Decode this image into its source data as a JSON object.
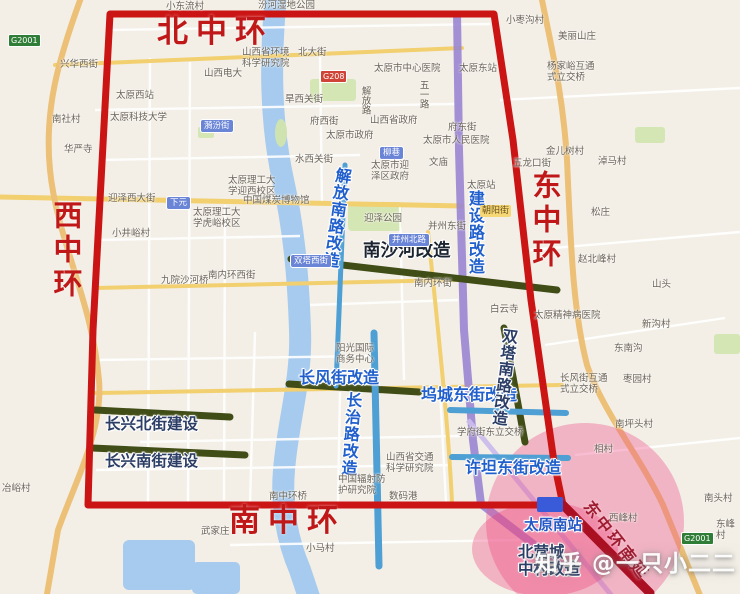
{
  "meta": {
    "watermark": "知乎 @一只小二二"
  },
  "colors": {
    "ring_text_red": "#c01818",
    "boundary_red": "#cb1414",
    "extension_red": "#ab0f22",
    "project_green_bar": "#414d16",
    "project_blue_bar": "#4d9fd4",
    "railway_purple": "#9a85d2",
    "project_text_blue": "#2160cc",
    "project_text_navy": "#2c3e66",
    "development_zone_pink": "#f0548c",
    "road_yellow": "#f2cf6f",
    "water_blue": "#a6cbee"
  },
  "rings": {
    "north": "北中环",
    "south": "南中环",
    "west": "西中环",
    "east": "东中环"
  },
  "projects": [
    "解放南路改造",
    "建设路改造",
    "南沙河改造",
    "长风街改造",
    "长治路改造",
    "坞城东街改造",
    "双塔南路改造",
    "许坦东街改造",
    "长兴北街建设",
    "长兴南街建设",
    "东中环南延",
    "北营城中村改造"
  ],
  "labels": [
    {
      "name": "ring-label-north",
      "text": "北中环",
      "x": 157,
      "y": 17,
      "cls": "ring"
    },
    {
      "name": "ring-label-south",
      "text": "南中环",
      "x": 229,
      "y": 506,
      "cls": "ring"
    },
    {
      "name": "ring-label-west",
      "text": "西中环",
      "x": 51,
      "y": 200,
      "cls": "ringv"
    },
    {
      "name": "ring-label-east",
      "text": "东中环",
      "x": 530,
      "y": 170,
      "cls": "ringv"
    },
    {
      "name": "project-label-jiefang-south-rd",
      "text": "解放南路改造",
      "x": 334,
      "y": 166,
      "cls": "projv halo",
      "rot": 8
    },
    {
      "name": "project-label-jianshe-rd",
      "text": "建设路改造",
      "x": 466,
      "y": 190,
      "cls": "projv halo"
    },
    {
      "name": "project-label-nanshahe",
      "text": "南沙河改造",
      "x": 363,
      "y": 242,
      "cls": "projdark halo"
    },
    {
      "name": "project-label-changfeng-st",
      "text": "长风街改造",
      "x": 299,
      "y": 369,
      "cls": "proj halo"
    },
    {
      "name": "project-label-changzhi-rd",
      "text": "长治路改造",
      "x": 344,
      "y": 391,
      "cls": "projv halo",
      "rot": 4
    },
    {
      "name": "project-label-wucheng-east-st",
      "text": "坞城东街改造",
      "x": 421,
      "y": 386,
      "cls": "proj halo"
    },
    {
      "name": "project-label-shuangta-south-rd",
      "text": "双塔南路改造",
      "x": 501,
      "y": 327,
      "cls": "projvnavy halo",
      "rot": 7
    },
    {
      "name": "project-label-xutan-east-st",
      "text": "许坦东街改造",
      "x": 465,
      "y": 459,
      "cls": "proj halo"
    },
    {
      "name": "project-label-changxing-north-st",
      "text": "长兴北街建设",
      "x": 105,
      "y": 416,
      "cls": "projnavy halo"
    },
    {
      "name": "project-label-changxing-south-st",
      "text": "长兴南街建设",
      "x": 105,
      "y": 453,
      "cls": "projnavy halo"
    },
    {
      "name": "project-label-east-ring-south-extension",
      "text": "东中环南延",
      "x": 594,
      "y": 498,
      "cls": "ext",
      "rot": 52
    },
    {
      "name": "station-label-taiyuan-south",
      "text": "太原南站",
      "x": 524,
      "y": 518,
      "cls": "station halo"
    },
    {
      "name": "project-label-beiying-village",
      "text": "北营城\n中村改造",
      "x": 518,
      "y": 544,
      "cls": "projnavy halo"
    },
    {
      "name": "road-badge-g2001-west",
      "text": "G2001",
      "x": 8,
      "y": 34,
      "cls": "badge-g"
    },
    {
      "name": "road-badge-g2001-southeast",
      "text": "G2001",
      "x": 681,
      "y": 532,
      "cls": "badge-g"
    },
    {
      "name": "road-badge-g208",
      "text": "G208",
      "x": 320,
      "y": 70,
      "cls": "badge-r"
    },
    {
      "name": "road-badge-xiayuan",
      "text": "下元",
      "x": 166,
      "y": 196,
      "cls": "badge-b"
    },
    {
      "name": "road-badge-yifen-st",
      "text": "漪汾街",
      "x": 200,
      "y": 119,
      "cls": "badge-b"
    },
    {
      "name": "road-badge-liuxiang",
      "text": "柳巷",
      "x": 379,
      "y": 146,
      "cls": "badge-b"
    },
    {
      "name": "road-badge-bingzhou-north-rd",
      "text": "并州北路",
      "x": 388,
      "y": 233,
      "cls": "badge-b"
    },
    {
      "name": "road-badge-shuangta-west-st",
      "text": "双塔西街",
      "x": 290,
      "y": 254,
      "cls": "badge-b"
    },
    {
      "name": "road-badge-chaoyang-st",
      "text": "朝阳街",
      "x": 480,
      "y": 205,
      "cls": "badge-y"
    },
    {
      "name": "map-label-village",
      "text": "小东流村",
      "x": 166,
      "y": 2,
      "cls": "base"
    },
    {
      "name": "map-label-park",
      "text": "汾河湿地公园",
      "x": 258,
      "y": 1,
      "cls": "base"
    },
    {
      "name": "map-label-street",
      "text": "兴华西街",
      "x": 60,
      "y": 60,
      "cls": "base"
    },
    {
      "name": "map-label-station",
      "text": "太原西站",
      "x": 116,
      "y": 91,
      "cls": "base"
    },
    {
      "name": "map-label-university",
      "text": "太原科技大学",
      "x": 110,
      "y": 113,
      "cls": "base"
    },
    {
      "name": "map-label-village",
      "text": "南社村",
      "x": 52,
      "y": 115,
      "cls": "base"
    },
    {
      "name": "map-label-temple",
      "text": "华严寺",
      "x": 64,
      "y": 145,
      "cls": "base"
    },
    {
      "name": "map-label-university",
      "text": "山西电大",
      "x": 204,
      "y": 69,
      "cls": "base"
    },
    {
      "name": "map-label-institute",
      "text": "山西省环境\n科学研究院",
      "x": 242,
      "y": 48,
      "cls": "base"
    },
    {
      "name": "map-label-street",
      "text": "北大街",
      "x": 298,
      "y": 48,
      "cls": "base"
    },
    {
      "name": "map-label-street",
      "text": "旱西关街",
      "x": 285,
      "y": 95,
      "cls": "base"
    },
    {
      "name": "map-label-street",
      "text": "府西街",
      "x": 310,
      "y": 117,
      "cls": "base"
    },
    {
      "name": "map-label-government",
      "text": "太原市政府",
      "x": 326,
      "y": 131,
      "cls": "base"
    },
    {
      "name": "map-label-street",
      "text": "水西关街",
      "x": 295,
      "y": 155,
      "cls": "base"
    },
    {
      "name": "map-label-street",
      "text": "迎泽西大街",
      "x": 108,
      "y": 194,
      "cls": "base"
    },
    {
      "name": "map-label-university",
      "text": "太原理工大\n学迎西校区",
      "x": 228,
      "y": 176,
      "cls": "base"
    },
    {
      "name": "map-label-museum",
      "text": "中国煤炭博物馆",
      "x": 243,
      "y": 196,
      "cls": "base"
    },
    {
      "name": "map-label-university",
      "text": "太原理工大\n学虎峪校区",
      "x": 193,
      "y": 208,
      "cls": "base"
    },
    {
      "name": "map-label-village",
      "text": "小井峪村",
      "x": 112,
      "y": 229,
      "cls": "base"
    },
    {
      "name": "map-label-bridge",
      "text": "九院沙河桥",
      "x": 161,
      "y": 276,
      "cls": "base"
    },
    {
      "name": "map-label-street",
      "text": "南内环西街",
      "x": 208,
      "y": 271,
      "cls": "base"
    },
    {
      "name": "map-label-park",
      "text": "迎泽公园",
      "x": 364,
      "y": 214,
      "cls": "base"
    },
    {
      "name": "map-label-government",
      "text": "山西省政府",
      "x": 370,
      "y": 116,
      "cls": "base"
    },
    {
      "name": "map-label-hospital",
      "text": "太原市中心医院",
      "x": 374,
      "y": 64,
      "cls": "base"
    },
    {
      "name": "map-label-station",
      "text": "太原东站",
      "x": 459,
      "y": 64,
      "cls": "base"
    },
    {
      "name": "map-label-road",
      "text": "五一路",
      "x": 417,
      "y": 80,
      "cls": "basev"
    },
    {
      "name": "map-label-road",
      "text": "解放路",
      "x": 359,
      "y": 86,
      "cls": "basev"
    },
    {
      "name": "map-label-street",
      "text": "府东街",
      "x": 448,
      "y": 123,
      "cls": "base"
    },
    {
      "name": "map-label-hospital",
      "text": "太原市人民医院",
      "x": 423,
      "y": 136,
      "cls": "base"
    },
    {
      "name": "map-label-temple",
      "text": "文庙",
      "x": 429,
      "y": 158,
      "cls": "base"
    },
    {
      "name": "map-label-government",
      "text": "太原市迎\n泽区政府",
      "x": 371,
      "y": 161,
      "cls": "base"
    },
    {
      "name": "map-label-street",
      "text": "并州东街",
      "x": 428,
      "y": 222,
      "cls": "base"
    },
    {
      "name": "map-label-street",
      "text": "南内环街",
      "x": 414,
      "y": 279,
      "cls": "base"
    },
    {
      "name": "map-label-street",
      "text": "五龙口街",
      "x": 513,
      "y": 159,
      "cls": "base"
    },
    {
      "name": "map-label-village",
      "text": "金儿树村",
      "x": 546,
      "y": 147,
      "cls": "base"
    },
    {
      "name": "map-label-village",
      "text": "淖马村",
      "x": 598,
      "y": 157,
      "cls": "base"
    },
    {
      "name": "map-label-village",
      "text": "松庄",
      "x": 591,
      "y": 208,
      "cls": "base"
    },
    {
      "name": "map-label-place",
      "text": "美丽山庄",
      "x": 558,
      "y": 32,
      "cls": "base"
    },
    {
      "name": "map-label-interchange",
      "text": "杨家峪互通\n式立交桥",
      "x": 547,
      "y": 62,
      "cls": "base"
    },
    {
      "name": "map-label-village",
      "text": "小枣沟村",
      "x": 506,
      "y": 16,
      "cls": "base"
    },
    {
      "name": "map-label-station",
      "text": "太原站",
      "x": 467,
      "y": 181,
      "cls": "base"
    },
    {
      "name": "map-label-temple",
      "text": "白云寺",
      "x": 490,
      "y": 305,
      "cls": "base"
    },
    {
      "name": "map-label-hospital",
      "text": "太原精神病医院",
      "x": 534,
      "y": 311,
      "cls": "base"
    },
    {
      "name": "map-label-village",
      "text": "赵北峰村",
      "x": 578,
      "y": 255,
      "cls": "base"
    },
    {
      "name": "map-label-village",
      "text": "山头",
      "x": 652,
      "y": 280,
      "cls": "base"
    },
    {
      "name": "map-label-village",
      "text": "东南沟",
      "x": 614,
      "y": 344,
      "cls": "base"
    },
    {
      "name": "map-label-village",
      "text": "新沟村",
      "x": 642,
      "y": 320,
      "cls": "base"
    },
    {
      "name": "map-label-village",
      "text": "枣园村",
      "x": 623,
      "y": 375,
      "cls": "base"
    },
    {
      "name": "map-label-interchange",
      "text": "长风街互通\n式立交桥",
      "x": 560,
      "y": 374,
      "cls": "base"
    },
    {
      "name": "map-label-village",
      "text": "南坪头村",
      "x": 615,
      "y": 420,
      "cls": "base"
    },
    {
      "name": "map-label-interchange",
      "text": "学府街东立交桥",
      "x": 457,
      "y": 428,
      "cls": "base"
    },
    {
      "name": "map-label-institute",
      "text": "山西省交通\n科学研究院",
      "x": 386,
      "y": 453,
      "cls": "base"
    },
    {
      "name": "map-label-building",
      "text": "阳光国际\n商务中心",
      "x": 336,
      "y": 344,
      "cls": "base"
    },
    {
      "name": "map-label-institute",
      "text": "中国辐射防\n护研究院",
      "x": 338,
      "y": 475,
      "cls": "base"
    },
    {
      "name": "map-label-place",
      "text": "数码港",
      "x": 389,
      "y": 492,
      "cls": "base"
    },
    {
      "name": "map-label-bridge",
      "text": "南中环桥",
      "x": 269,
      "y": 492,
      "cls": "base"
    },
    {
      "name": "map-label-village",
      "text": "小马村",
      "x": 306,
      "y": 544,
      "cls": "base"
    },
    {
      "name": "map-label-village",
      "text": "武家庄",
      "x": 201,
      "y": 527,
      "cls": "base"
    },
    {
      "name": "map-label-village",
      "text": "冶峪村",
      "x": 2,
      "y": 484,
      "cls": "base"
    },
    {
      "name": "map-label-village",
      "text": "西峰村",
      "x": 609,
      "y": 514,
      "cls": "base"
    },
    {
      "name": "map-label-village",
      "text": "相村",
      "x": 594,
      "y": 445,
      "cls": "base"
    },
    {
      "name": "map-label-village",
      "text": "南头村",
      "x": 704,
      "y": 494,
      "cls": "base"
    },
    {
      "name": "map-label-village",
      "text": "东峰村",
      "x": 716,
      "y": 520,
      "cls": "base"
    }
  ]
}
